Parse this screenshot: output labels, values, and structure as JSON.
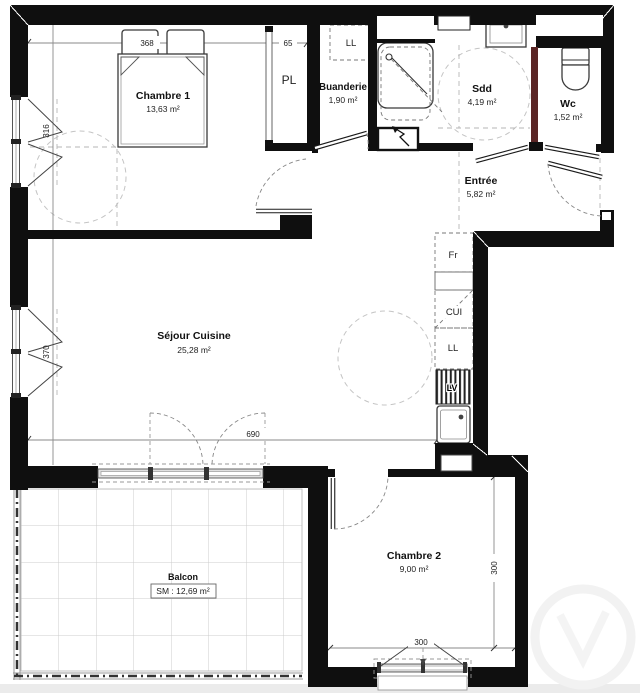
{
  "plan": {
    "rooms": {
      "chambre1": {
        "name": "Chambre 1",
        "area": "13,63 m²"
      },
      "buanderie": {
        "name": "Buanderie",
        "area": "1,90 m²"
      },
      "sdd": {
        "name": "Sdd",
        "area": "4,19 m²"
      },
      "wc": {
        "name": "Wc",
        "area": "1,52 m²"
      },
      "entree": {
        "name": "Entrée",
        "area": "5,82 m²"
      },
      "sejour": {
        "name": "Séjour Cuisine",
        "area": "25,28 m²"
      },
      "chambre2": {
        "name": "Chambre 2",
        "area": "9,00 m²"
      },
      "balcon": {
        "name": "Balcon",
        "surface": "SM : 12,69 m²"
      }
    },
    "fixtures": {
      "closet": "PL",
      "laundry_hookup": "LL",
      "fridge": "Fr",
      "kitchen_unit": "CUI",
      "washing_machine": "LL",
      "dishwasher": "LV"
    },
    "dimensions": {
      "chambre1_width": "368",
      "closet_depth": "65",
      "chambre1_window": "316",
      "sejour_window": "370",
      "sejour_width": "690",
      "chambre2_height": "300",
      "chambre2_window": "300"
    },
    "colors": {
      "wall": "#0f0f0f",
      "wc_partition": "#5a2525",
      "dim_line": "#8a8a8a",
      "guide": "#b5b5b5"
    }
  }
}
